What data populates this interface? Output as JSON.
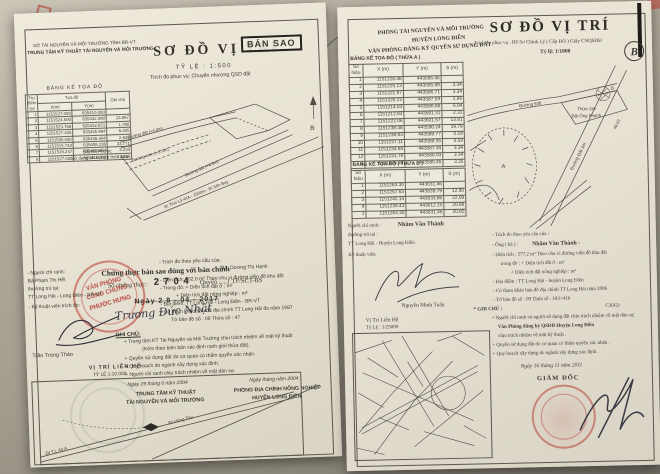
{
  "left_doc": {
    "agency1": "SỞ TÀI NGUYÊN VÀ MÔI TRƯỜNG TỈNH BR-VT",
    "agency2": "TRUNG TÂM KỸ THUẬT TÀI NGUYÊN VÀ MÔI TRƯỜNG",
    "title": "SƠ ĐỒ VỊ TRÍ",
    "copy_stamp": "BẢN SAO",
    "scale": "TỶ LỆ : 1:500",
    "purpose": "Trích đo phục vụ: Chuyển nhượng QSD đất",
    "table": {
      "title": "BẢNG KÊ TỌA ĐỘ",
      "col_point": "Trụ điểm Số",
      "col_coord": "Tọa độ",
      "col_x": "X(m)",
      "col_y": "Y(m)",
      "col_note": "Ghi chú",
      "rows": [
        [
          "1",
          "1151527.000",
          "635410.000",
          ""
        ],
        [
          "2",
          "1151524.500",
          "635432.090",
          "13.867"
        ],
        [
          "3",
          "1151523.756",
          "635432.871",
          "1.790"
        ],
        [
          "4",
          "1151527.435",
          "635435.964",
          "6.405"
        ],
        [
          "5",
          "1151530.040",
          "635436.404",
          "2.639"
        ],
        [
          "6",
          "1151515.744",
          "635408.236",
          "33.771"
        ],
        [
          "7",
          "1151518.247",
          "635408.694",
          "3.235"
        ],
        [
          "8",
          "1151527.030",
          "635415.302",
          "12.658"
        ]
      ]
    },
    "owner_note1": "Đất Bà Phước",
    "owner_note2": "Sử dụng chưa hợp thức hóa",
    "diagram": {
      "road1": "Đường đất (+4.0m)",
      "road2": "Đường mòn (+2.0m)",
      "road3": "Đường đất (+4.5m)",
      "road4": "Đi Tỉnh Lộ 44A - 2500m - Đi Sân Bay",
      "north": "B"
    },
    "certify": {
      "line": "Chứng thực bản sao đúng với bản chính",
      "no_label": "Số chứng thực:",
      "no_value": "2 7 0 4",
      "book": "Quyển .....1 TP/SCT-BS",
      "date": "Ngày 2 8 - 04 - 2017"
    },
    "notary_stamp": {
      "l1": "VĂN PHÒNG",
      "l2": "CÔNG CHỨNG",
      "l3": "PHƯỚC HƯNG"
    },
    "left_col": {
      "l1": "- Người chỉ ranh:",
      "l2": "Bà Phạm Thị Hết",
      "l3": "thường trú tại:",
      "l4": "TT Long Hải - Long Điền - BR-VT",
      "l5": "- Kỹ thuật viên trích đo:",
      "name": "Trần Trọng Thảo"
    },
    "right_col": {
      "l1": "- Trích đo theo yêu cầu của:",
      "l2": "Bà:   Dương Thị Hạnh",
      "l3": "- Diện tích: 202.0  m²  Theo chu vi đường viền đồ khu đất",
      "l4": "- Trong đó:  + Diện tích đất ở :                       m²",
      "l5": "+ Diện tích đất nông nghiệp :              m²",
      "l6": "- Địa điểm: TT Long Hải - Long Điền - BR-VT",
      "l7": "- Có tham khảo bản đồ địa chính TT Long Hải  đo năm  1997",
      "l8": "Tờ bản đồ số :   09              Thửa số :      47"
    },
    "signature_name": "Trương Đức Nhật",
    "notes_title": "GHI CHÚ:",
    "notes": [
      "+ Trung tâm KT Tài Nguyên và Môi Trường chịu trách nhiệm về mặt kỹ thuật",
      "(Kèm theo biên bản xác định ranh giới thửa đất).",
      "+ Quyền sử dụng đất do cơ quan có thẩm quyền xác nhận.",
      "+ Quy hoạch do ngành xây dựng xác định.",
      "+ Người chỉ ranh chịu trách nhiệm về mặt dân sự."
    ],
    "date_left": "Ngày 29 tháng 6 năm 2004",
    "date_right": "Ngày      tháng      năm 2004",
    "org_left1": "TRUNG TÂM KỸ THUẬT",
    "org_left2": "TÀI NGUYÊN VÀ MÔI TRƯỜNG",
    "org_right1": "PHÒNG ĐỊA CHÍNH NÔNG NGHIỆP",
    "org_right2": "HUYỆN LONG ĐIỀN",
    "inset": {
      "title": "VỊ TRÍ LIÊN HỆ",
      "scale": "TỶ LỆ 1:10.000",
      "road_a": "ĐI T.L 44 A",
      "road_b": "Đi Vũng Tàu"
    }
  },
  "right_doc": {
    "agency1": "PHÒNG TÀI NGUYÊN VÀ MÔI TRƯỜNG",
    "agency2": "HUYỆN LONG ĐIỀN",
    "agency3": "VĂN PHÒNG ĐĂNG KÝ QUYỀN SỬ DỤNG ĐẤT",
    "title": "SƠ ĐỒ VỊ TRÍ",
    "purpose": "Trích đo phục vụ  :  Hồ Sơ Chỉnh Lý ( Cấp Đổi ) Giấy CNQSDĐ",
    "scale": "Tỷ lệ: 1/1000",
    "north_monogram": "B",
    "table_a": {
      "title": "BẢNG KÊ TỌA ĐỘ ( THỬA A )",
      "col_no": "Số hiệu",
      "col_x": "X (m)",
      "col_y": "Y (m)",
      "col_s": "S (m)",
      "rows": [
        [
          "1",
          "1151228.48",
          "443585.45",
          ""
        ],
        [
          "2",
          "1151225.13",
          "443585.89",
          "3.34"
        ],
        [
          "3",
          "1151221.97",
          "443586.71",
          "3.34"
        ],
        [
          "4",
          "1151220.22",
          "443587.59",
          "1.96"
        ],
        [
          "5",
          "1151214.63",
          "443588.88",
          "6.04"
        ],
        [
          "6",
          "1151212.83",
          "443591.31",
          "2.31"
        ],
        [
          "7",
          "1151222.06",
          "443601.57",
          "13.81"
        ],
        [
          "8",
          "1151238.38",
          "443590.24",
          "19.79"
        ],
        [
          "9",
          "1151238.83",
          "443589.77",
          "0.59"
        ],
        [
          "10",
          "1151237.11",
          "443589.35",
          "0.59"
        ],
        [
          "11",
          "1151234.84",
          "443587.34",
          "3.34"
        ],
        [
          "12",
          "1151231.78",
          "443586.03",
          "3.34"
        ],
        [
          "1",
          "1151228.48",
          "443585.45",
          "3.35"
        ]
      ]
    },
    "table_b": {
      "title": "BẢNG KÊ TỌA ĐỘ ( THỬA B )",
      "col_no": "Số hiệu",
      "col_x": "X (m)",
      "col_y": "Y (m)",
      "col_s": "S (m)",
      "rows": [
        [
          "1",
          "1151263.30",
          "443631.46",
          ""
        ],
        [
          "2",
          "1151257.63",
          "443639.79",
          "12.90"
        ],
        [
          "3",
          "1151242.14",
          "443633.86",
          "22.09"
        ],
        [
          "4",
          "1151239.43",
          "443612.15",
          "20.88"
        ],
        [
          "1",
          "1151263.30",
          "443631.46",
          "20.85"
        ]
      ]
    },
    "left_col": {
      "l1": "Người chỉ ranh :",
      "name": "Nhâm Văn Thành",
      "l2": "thường trú tại :",
      "l3": "TT Long Hải - Huyện Long Điền",
      "l4": "Kỹ thuật viên",
      "tech_name": "Nguyễn Minh Tuấn",
      "inset_title": "Vị Trí Liên Hệ",
      "inset_scale": "Tỷ Lệ : 1/25000"
    },
    "right_col": {
      "l1": "- Trích đo theo yêu cầu của :",
      "l2_label": "- Ông ( bà ) :",
      "l2_name": "Nhâm Văn Thành -",
      "l3": "- Diện tích :    577.2  m²   Theo chu vi đường viền đồ khu đất",
      "l4": "trong đó :  + Diện tích đất ở :                          m²",
      "l5": "+ Diện tích đất nông nghiệp :               m²",
      "l6": "- Địa điểm :  TT Long Hải - huyện Long Điền",
      "l7": "- Có tham khảo bản đồ địa chính TT Long Hải năm 2006",
      "l8": "- Tờ bản đồ số :   09                Thửa số :   183+416",
      "l9": "C3(42)"
    },
    "notes_title": "* GHI CHÚ :",
    "notes": [
      "+ Người chỉ ranh và người sử dụng đất chịu trách nhiệm về mặt dân sự,",
      "Văn Phòng đăng ký QSDĐ Huyện Long Điền",
      "chịu trách nhiệm về mặt kỹ thuật .",
      "+ Quyền sử dụng đất do cơ quan có thẩm quyền xác nhận .",
      "+ Quy hoạch xây dựng do ngành xây dựng xác định ."
    ],
    "date_line": "Ngày 16  tháng 11  năm  2011",
    "director": "GIÁM ĐỐC",
    "diagram": {
      "road_top": "Đường Đất",
      "road_diag": "Đường Đất 3m",
      "dim": "48.02",
      "parcel1": "Thửa 116",
      "parcel2": "Đất Ông Khanh",
      "label_a": "A",
      "label_b": "B"
    }
  },
  "colors": {
    "stamp_red": "#b03a2e",
    "notary_red": "#c0392b",
    "faint_teal": "#6e847c"
  }
}
